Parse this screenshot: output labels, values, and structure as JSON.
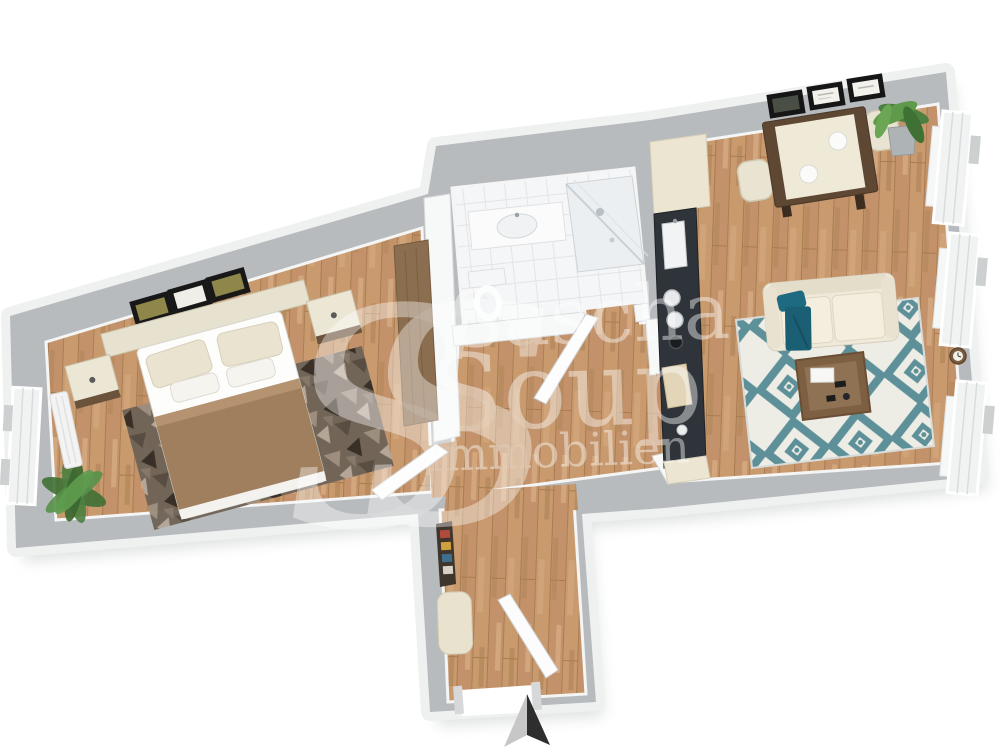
{
  "watermark": {
    "monogram": "SS",
    "line1": "Sascha",
    "line2": "Soup",
    "line3": "Immobilien"
  },
  "compass": {
    "direction": "north"
  },
  "palette": {
    "background": "#ffffff",
    "wall_top": "#b8bbbd",
    "wall_outer_edge": "#eff1f1",
    "interior_wall": "#f7f8f8",
    "wood_floor": "#c89a6e",
    "tile_floor": "#f5f6f7",
    "cream_furniture": "#efe9da",
    "dark_wood": "#5e4733",
    "blanket_brown": "#a07f5e",
    "accent_teal": "#1e6a80",
    "rug_teal": "#5d9099",
    "bedroom_rug": "#6e6357",
    "counter_dark": "#2f343a",
    "plant_green": "#4c8040",
    "arrow_light": "#c7c7c7",
    "arrow_dark": "#2e2e2e"
  },
  "scene": {
    "type": "3d-floor-plan",
    "rooms": [
      {
        "name": "bedroom",
        "furniture": [
          "double-bed",
          "headboard",
          "nightstand",
          "nightstand",
          "wall-frames",
          "patterned-rug",
          "potted-plant",
          "wardrobe",
          "window",
          "radiator"
        ]
      },
      {
        "name": "bathroom",
        "furniture": [
          "vanity-sink",
          "toilet",
          "walk-in-shower",
          "bathroom-door"
        ]
      },
      {
        "name": "hallway",
        "furniture": [
          "wall-shelf",
          "storage-bench",
          "bedroom-door"
        ]
      },
      {
        "name": "entrance",
        "furniture": [
          "entrance-door",
          "door-opening"
        ]
      },
      {
        "name": "kitchen",
        "furniture": [
          "tall-cabinet",
          "dark-countertop",
          "sink",
          "cooktop-burners",
          "pot",
          "cutting-board",
          "base-cabinet"
        ]
      },
      {
        "name": "living-room",
        "furniture": [
          "dining-table",
          "dining-chair",
          "dining-chair",
          "wall-frames",
          "potted-plant",
          "sofa",
          "throw-pillow",
          "throw-blanket",
          "diamond-rug",
          "coffee-table",
          "window",
          "window",
          "window",
          "radiator",
          "wall-clock"
        ]
      }
    ]
  }
}
